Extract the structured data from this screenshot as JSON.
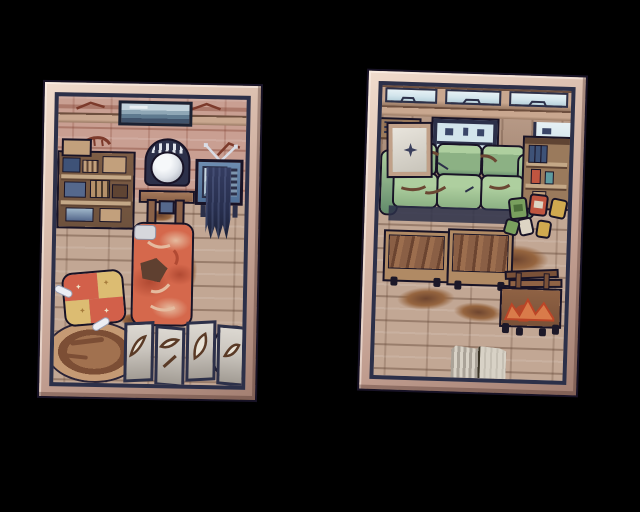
{
  "window": {
    "width": 640,
    "height": 512,
    "background": "#000000",
    "description": "Two framed pixel-art postcards of run-down rooms on a black background"
  },
  "panels": [
    {
      "id": "bedroom-postcard",
      "label": "Framed pixel-art postcard of a run-down bedroom",
      "objects": [
        "cracked pink wall with red cracks",
        "framed landscape painting on wall",
        "wooden beam",
        "cluttered wall shelf with boxes and books",
        "vanity table with round silver mirror",
        "television with rabbit-ear antenna",
        "dark ragged cloth draped over TV stand",
        "orange sleeping-bag bed with white pillow and dark patch",
        "patchwork red and yellow pet cushion",
        "two white bones",
        "oval brown rug",
        "four-panel grey folding screen with bone sketches",
        "grey boulder",
        "stone tile floor with dirt stains"
      ]
    },
    {
      "id": "living-room-postcard",
      "label": "Framed pixel-art postcard of a run-down living room",
      "objects": [
        "three transom windows with cloud outlines",
        "wooden beam",
        "back window with dark frame and panes",
        "side window",
        "wall shelf with stacked items",
        "framed picture with dark star leaning on couch",
        "torn green three-seat couch",
        "wooden bookshelf with blue books and cans",
        "pile of scattered cans and boxes",
        "two wooden benches",
        "dirt smears on stone floor",
        "wooden cart with orange cloth and top rack",
        "open striped book on floor"
      ]
    }
  ],
  "palette": {
    "outline-dark": "#181326",
    "inner-navy": "#2c3049",
    "frame-hi": "#f0dccd",
    "frame-light": "#dcc0b0",
    "frame-mid": "#c5a294",
    "frame-shadow": "#a37f72",
    "wall-pink": "#c99f92",
    "wall-crack": "#7c3a2b",
    "beam": "#c9a78f",
    "beam-line": "#6e4f3e",
    "floor-base": "#c2a794",
    "stain-dark": "#6e452f",
    "stain-mid": "#96653f",
    "bed-orange": "#d5684c",
    "bed-dark": "#b14a33",
    "bed-cream": "#e5bb9f",
    "bed-patch": "#5f4030",
    "pillow": "#d6d7dc",
    "cushion-red": "#d2604a",
    "cushion-yellow": "#dcbc72",
    "bone-white": "#eceef4",
    "rug-mid": "#a1714f",
    "rug-dark": "#7c4e35",
    "rug-light": "#c59a74",
    "screen-face": "#cbc6bf",
    "motif-brown": "#5a3a26",
    "mirror-glass": "#dfe3e9",
    "vanity-wood": "#8a6148",
    "tv-body": "#4f6f97",
    "tv-screen": "#a9bdcd",
    "drape": "#272e4d",
    "shelf-wood": "#6e523d",
    "shelf-light": "#c4a887",
    "box-blue": "#3e5277",
    "box-tan": "#c2a07c",
    "couch-green": "#8cb184",
    "couch-light": "#aecf9f",
    "couch-dark": "#628b6b",
    "tear-brown": "#6b4733",
    "window-glass": "#d3e5ec",
    "wood-wall": "#b0907b",
    "bench-wood": "#8a5f45",
    "bench-light": "#b08a64",
    "cart-wood": "#7a5138",
    "cart-orange": "#d97b4a",
    "cart-red": "#bb4527",
    "can-green": "#79a05e",
    "can-red": "#c05540",
    "can-yellow": "#d0a94f",
    "can-pale": "#ddd5c4",
    "book-page": "#d8d2c6",
    "book-stripe": "#aaa398",
    "bookshelf-wood": "#9a7a5c",
    "bookshelf-dark": "#5f4433",
    "rock-gray": "#b3aca4",
    "rock-dark": "#8b857c"
  }
}
